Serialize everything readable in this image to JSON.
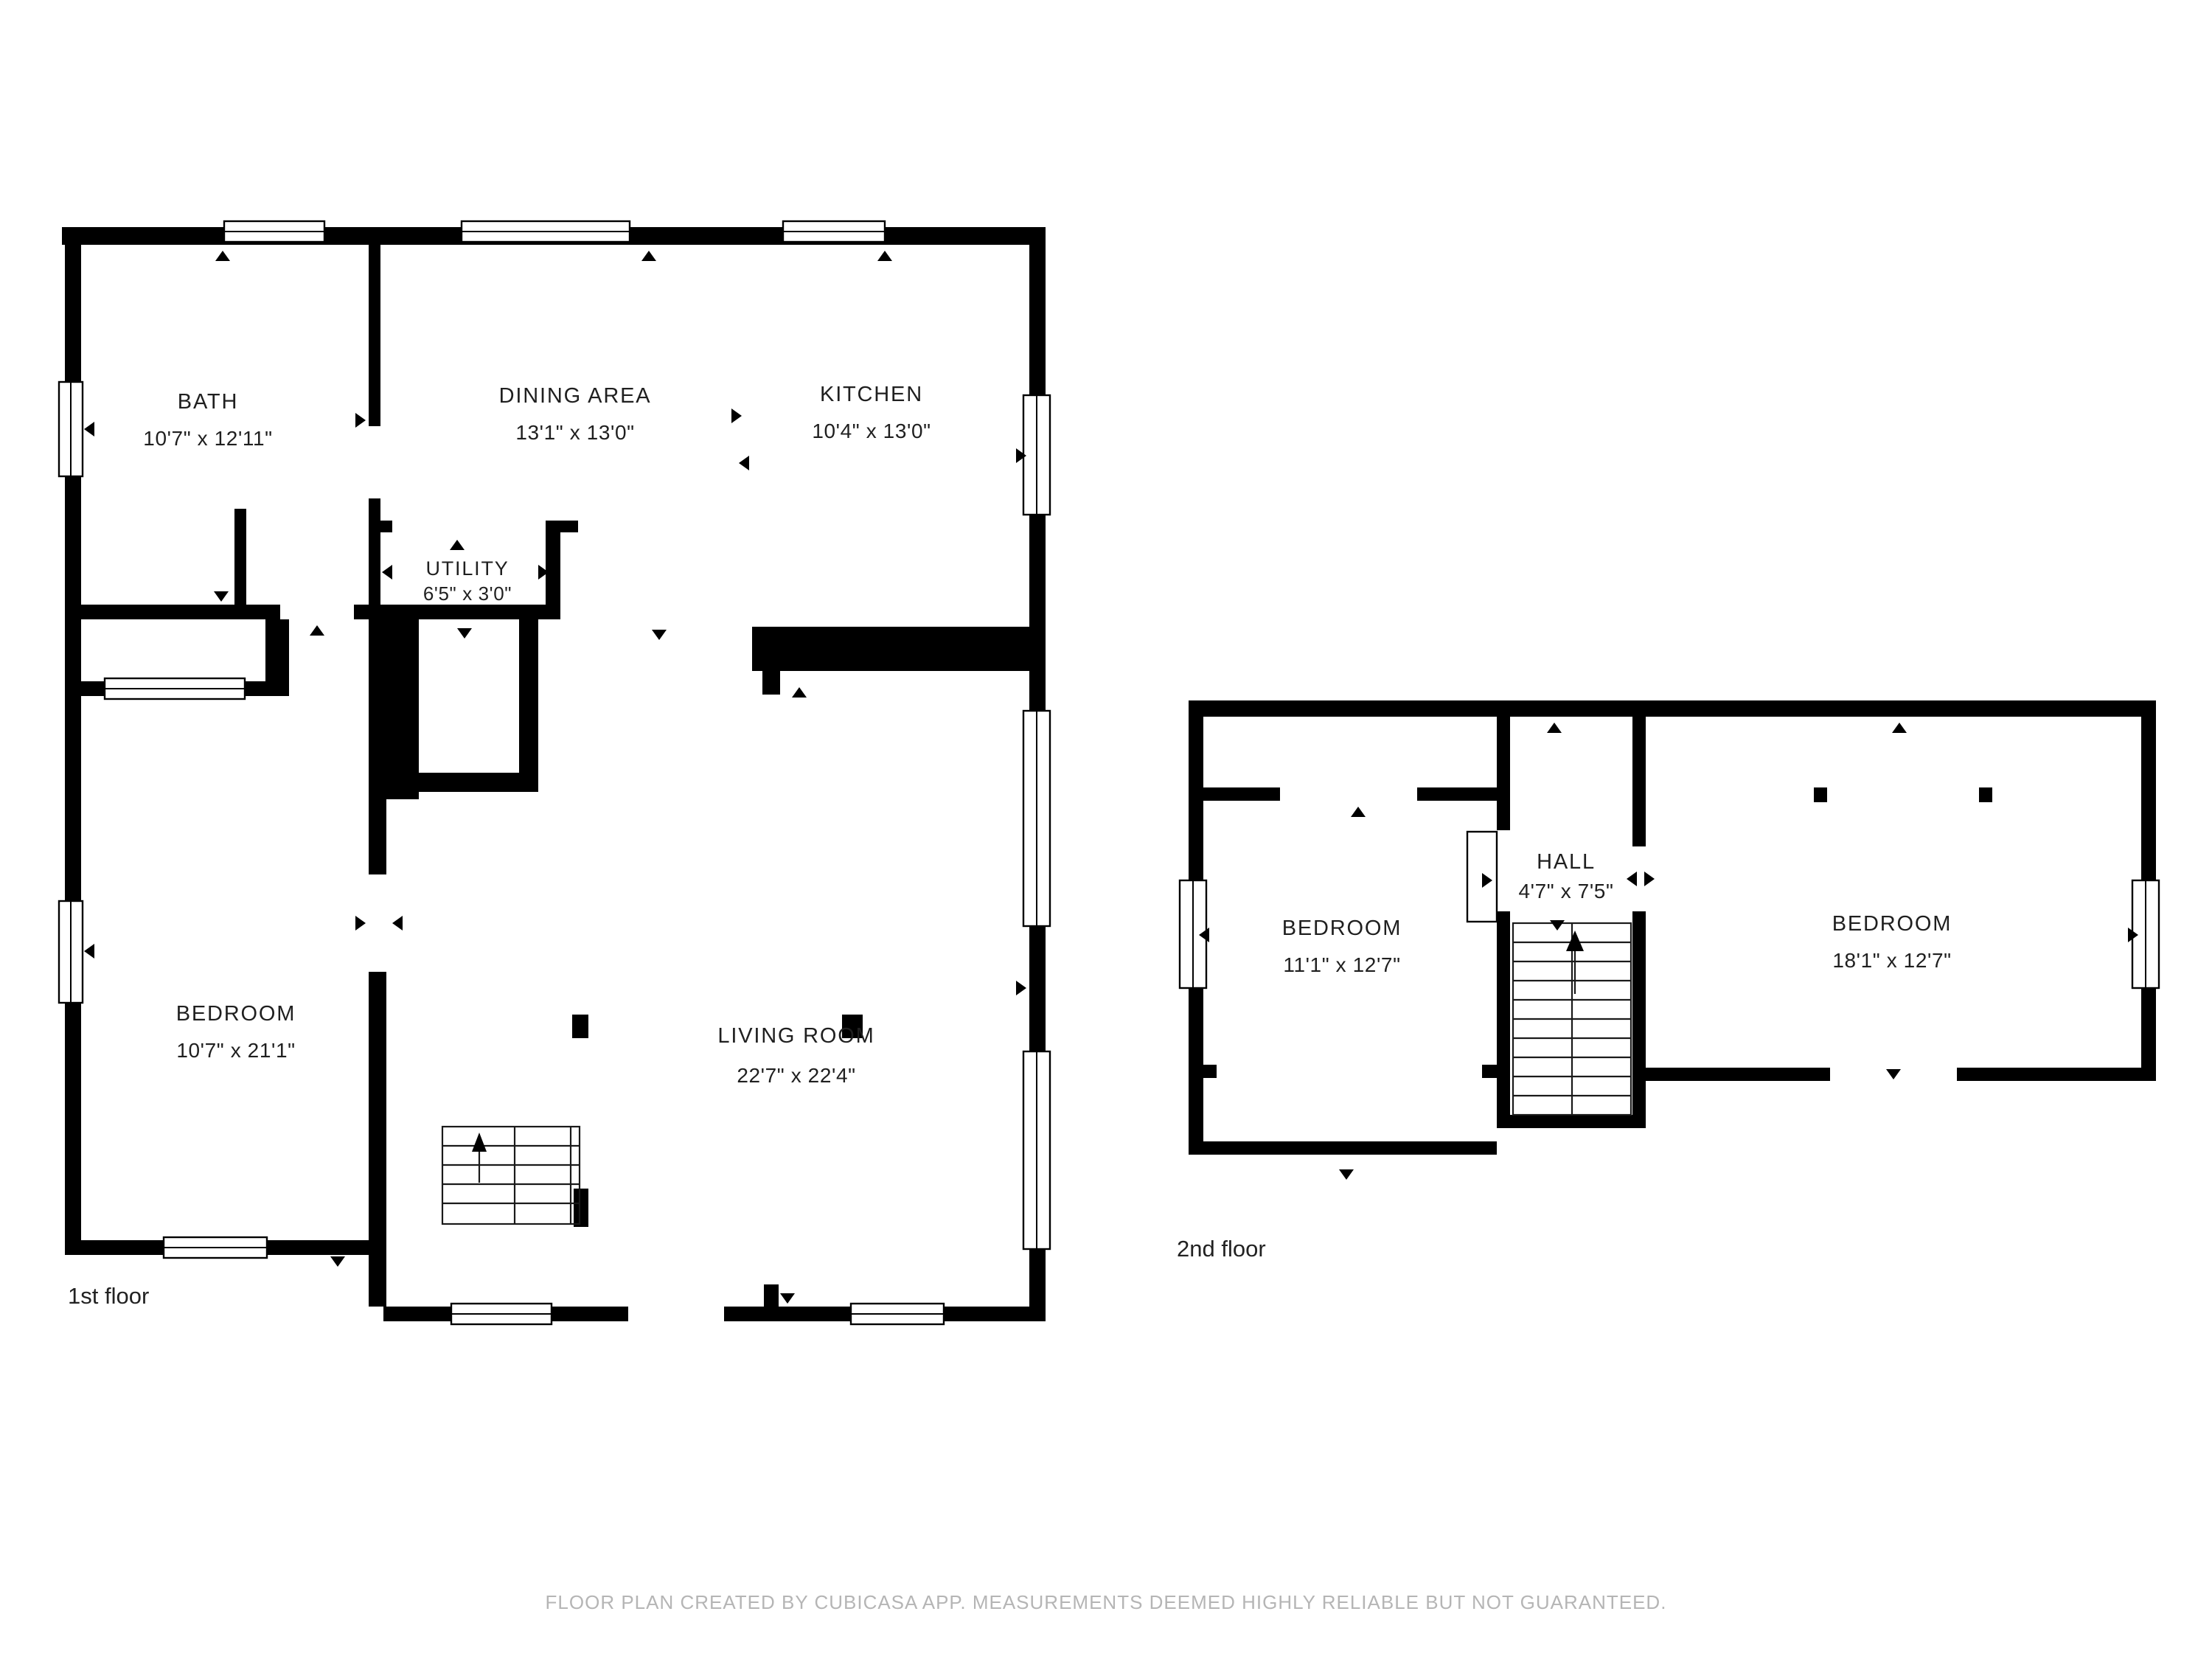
{
  "page": {
    "background": "#ffffff"
  },
  "floor1": {
    "label": "1st floor",
    "rooms": {
      "bath": {
        "name": "BATH",
        "dims": "10'7\" x 12'11\""
      },
      "dining": {
        "name": "DINING AREA",
        "dims": "13'1\" x 13'0\""
      },
      "kitchen": {
        "name": "KITCHEN",
        "dims": "10'4\" x 13'0\""
      },
      "utility": {
        "name": "UTILITY",
        "dims": "6'5\" x 3'0\""
      },
      "bedroom": {
        "name": "BEDROOM",
        "dims": "10'7\" x 21'1\""
      },
      "living_room": {
        "name": "LIVING ROOM",
        "dims": "22'7\" x 22'4\""
      }
    }
  },
  "floor2": {
    "label": "2nd floor",
    "rooms": {
      "bedroom_left": {
        "name": "BEDROOM",
        "dims": "11'1\" x 12'7\""
      },
      "hall": {
        "name": "HALL",
        "dims": "4'7\" x 7'5\""
      },
      "bedroom_right": {
        "name": "BEDROOM",
        "dims": "18'1\" x 12'7\""
      }
    }
  },
  "footer": {
    "disclaimer": "FLOOR PLAN CREATED BY CUBICASA APP. MEASUREMENTS DEEMED HIGHLY RELIABLE BUT NOT GUARANTEED."
  },
  "colors": {
    "wall": "#000000",
    "label_text": "#1f1f1f",
    "footer_text": "#b5b5b5"
  }
}
